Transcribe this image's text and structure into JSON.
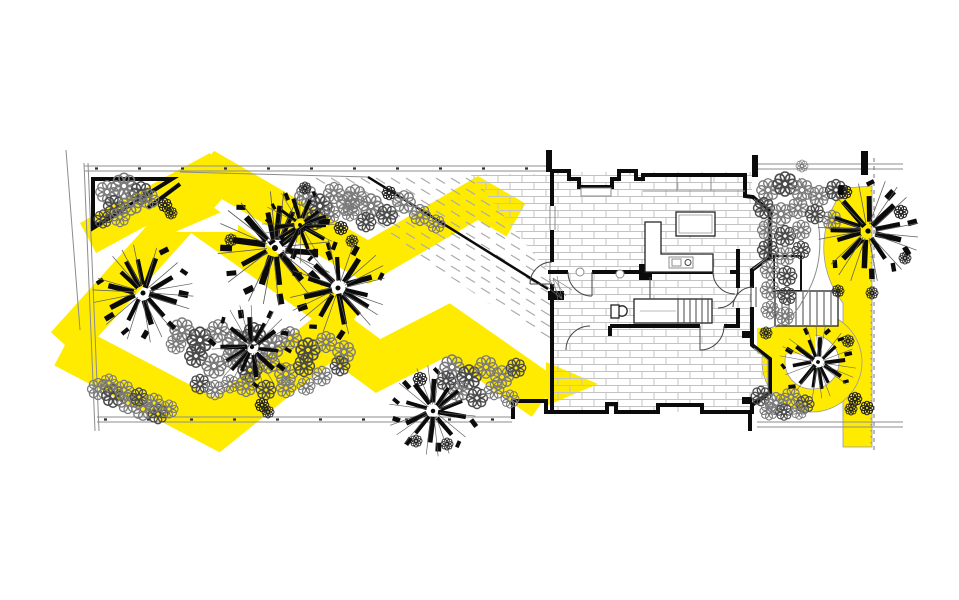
{
  "page": {
    "title": "Residential garden design plan",
    "description": "Black and white architectural landscape plan of a long rear garden, house ground floor and front garden, overlaid with a bright yellow chevron planting pattern and a curved yellow front path",
    "canvas": {
      "width": 959,
      "height": 600
    },
    "background": "#ffffff"
  },
  "colors": {
    "highlight": "#FFEB00",
    "ink": "#0b0b0b",
    "line": "#8c8c8c",
    "brick": "#c3c3c3",
    "hatch": "#ababab",
    "flower_light": "#7a7a7a",
    "flower_dark": "#242424"
  },
  "plan": {
    "areas": {
      "back_garden": {
        "label": "Back garden with chevron lawn pattern, trees and flower drifts"
      },
      "rear_patio": {
        "label": "Rear brick-paved patio with diagonal gravel band"
      },
      "house": {
        "label": "House ground floor: kitchen-diner, stair hall, front room, porch"
      },
      "front_garden": {
        "label": "Front garden bed with specimen trees"
      },
      "front_path": {
        "label": "Curved yellow front path looping around a tree"
      }
    },
    "legend": {
      "yellow": "Highlight / proposed planting-path pattern",
      "scribble": "Existing trees",
      "rosettes": "Shrub and flower planting",
      "brick": "Paved floor / patio",
      "hatch": "Gravel band"
    }
  }
}
